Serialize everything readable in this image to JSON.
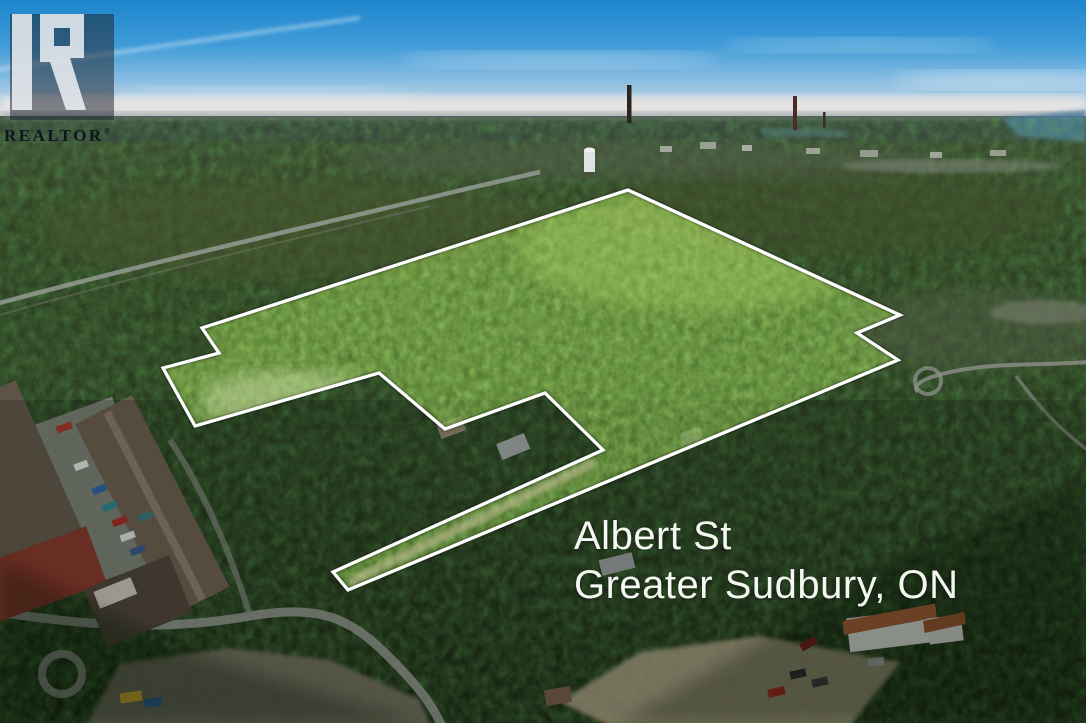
{
  "watermark": {
    "brand": "REALTOR",
    "registered": "®",
    "logo_letter_name": "realtor-block-r"
  },
  "address": {
    "line1": "Albert St",
    "line2": "Greater Sudbury, ON"
  },
  "parcel": {
    "points": "628,190 900,315 857,333 898,360 348,590 333,572 603,450 545,393 445,429 379,373 195,426 163,368 219,353 202,328",
    "outline_color": "#ffffff",
    "highlight_color": "#7fbe3c"
  },
  "colors": {
    "sky_top": "#1d86cd",
    "sky_horizon": "#e9e4e1",
    "forest_dark": "#222d17",
    "forest_lit": "#8cc63f",
    "road_gray": "#8d9089",
    "gravel_tan": "#a99d80",
    "roof_orange": "#b5673f"
  }
}
